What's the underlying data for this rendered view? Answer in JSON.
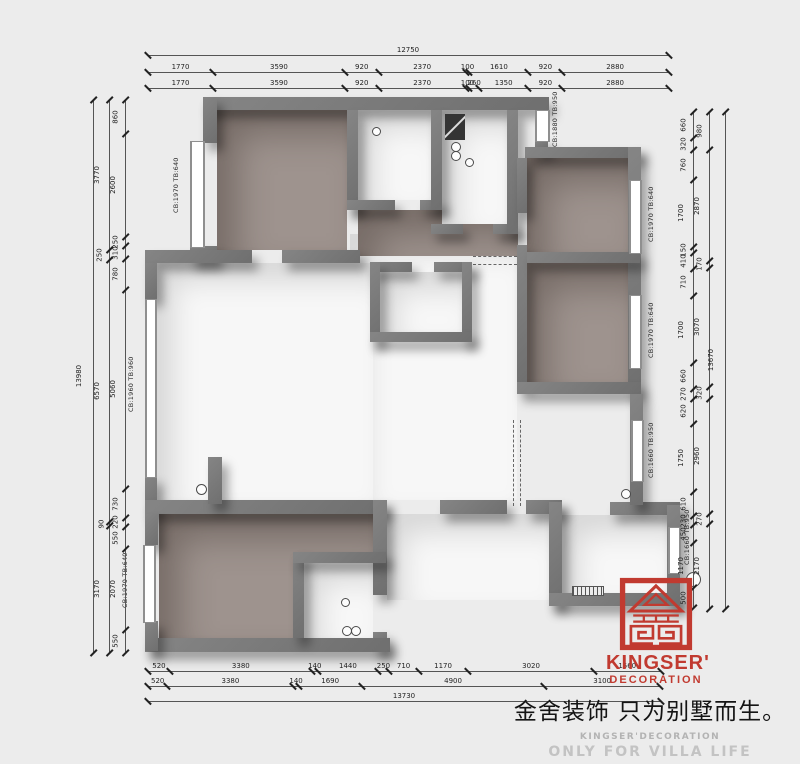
{
  "title": "Kingser Decoration floor plan",
  "dims": {
    "top_total": [
      12750
    ],
    "top_row2": [
      1770,
      3590,
      920,
      2370,
      100,
      1610,
      920,
      2880
    ],
    "top_row3": [
      1770,
      3590,
      920,
      2370,
      100,
      260,
      1350,
      920,
      2880
    ],
    "left_outer": [
      13980
    ],
    "left_mid": [
      3770,
      250,
      6570,
      90,
      3170
    ],
    "left_inner": [
      860,
      2600,
      250,
      310,
      780,
      5060,
      730,
      220,
      550,
      2070,
      550
    ],
    "right_inner": [
      660,
      320,
      760,
      1700,
      150,
      410,
      710,
      1700,
      660,
      270,
      620,
      1750,
      610,
      230,
      450,
      1170,
      500
    ],
    "right_mid": [
      980,
      2870,
      170,
      3070,
      320,
      2960,
      270,
      2170
    ],
    "right_outer": [
      13670
    ],
    "bottom_row1": [
      520,
      3380,
      140,
      1440,
      250,
      710,
      1170,
      3020,
      1560
    ],
    "bottom_row2": [
      520,
      3380,
      140,
      1690,
      4900,
      3100
    ],
    "bottom_total": [
      13730
    ]
  },
  "wall_tags": {
    "cb1970": "CB:1970 TB:640",
    "cb1960": "CB:1960 TB:960",
    "cb1880": "CB:1880 TB:950",
    "cb1660": "CB:1660 TB:950"
  },
  "logo": {
    "line1": "KINGSER'",
    "line2": "DECORATION"
  },
  "footer": {
    "slogan_cn": "金舍装饰 只为别墅而生。",
    "brand_en": "KINGSER'DECORATION",
    "tagline_en": "ONLY FOR VILLA LIFE"
  },
  "colors": {
    "logo_red": "#c13a30",
    "wall_gray": "#757575",
    "floor_taupe": "#9e938e",
    "background": "#ececec"
  }
}
